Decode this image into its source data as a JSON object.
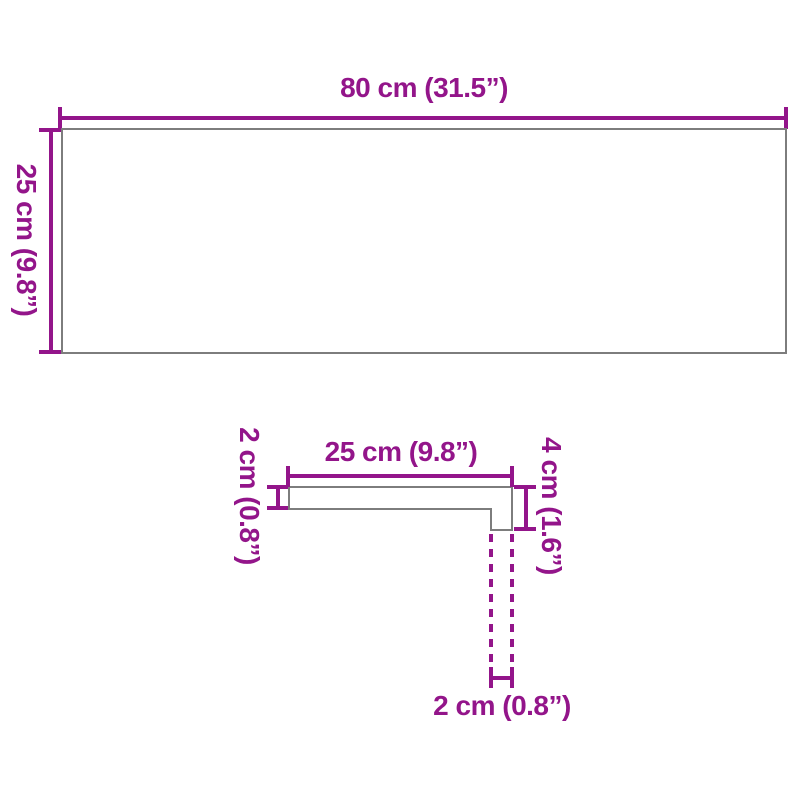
{
  "diagram_title": "product dimension diagram",
  "colors": {
    "dimension_magenta": "#93158A",
    "shape_outline": "#7D7D7D",
    "background": "#FFFFFF"
  },
  "top_view": {
    "description": "rectangular board seen from above",
    "width_label": "80 cm (31.5”)",
    "height_label": "25 cm (9.8”)"
  },
  "profile_view": {
    "description": "stair tread side profile with nosing lip",
    "width_label": "25 cm (9.8”)",
    "thickness_label": "2 cm (0.8”)",
    "height_label": "4 cm (1.6”)",
    "nosing_label": "2 cm (0.8”)"
  }
}
